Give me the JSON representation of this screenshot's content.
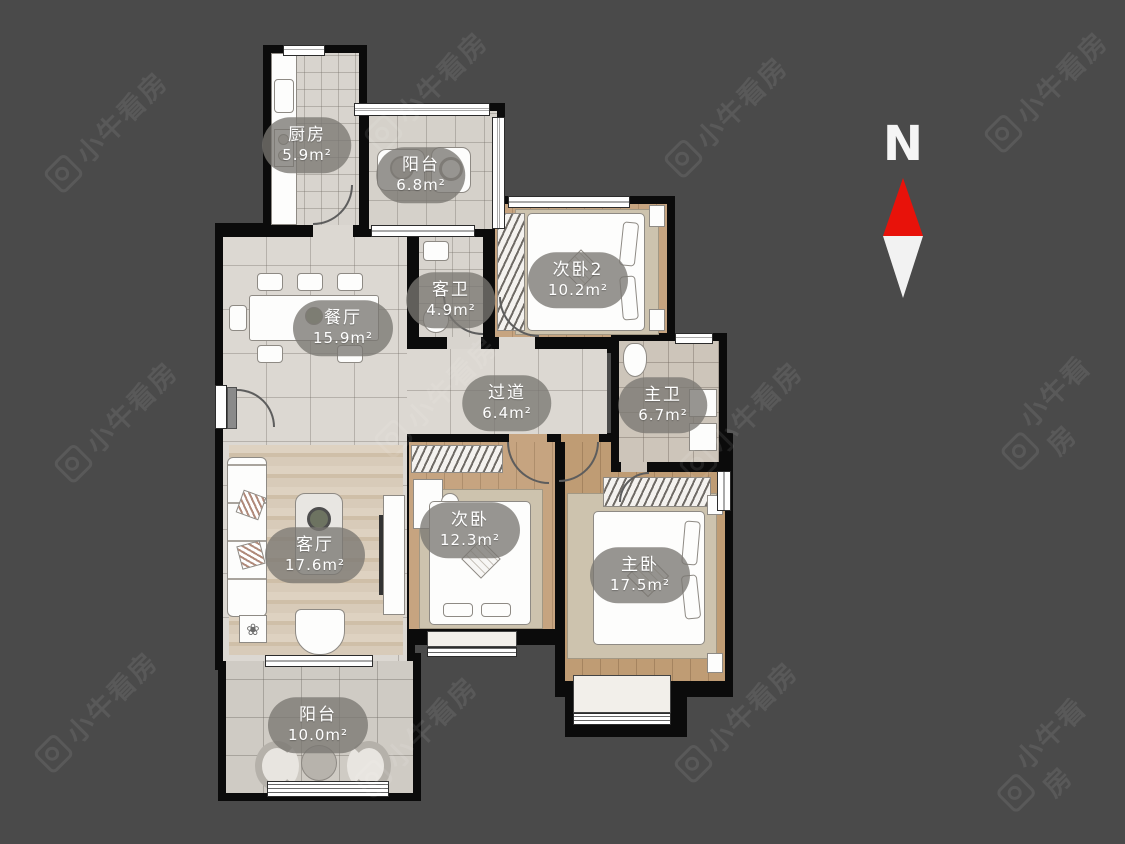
{
  "background": "#4a4a4a",
  "watermark": {
    "text": "小牛看房"
  },
  "compass": {
    "label": "N",
    "arrow_color": "#e8120a"
  },
  "rooms": [
    {
      "name": "厨房",
      "area": "5.9m²"
    },
    {
      "name": "阳台",
      "area": "6.8m²"
    },
    {
      "name": "次卧2",
      "area": "10.2m²"
    },
    {
      "name": "餐厅",
      "area": "15.9m²"
    },
    {
      "name": "客卫",
      "area": "4.9m²"
    },
    {
      "name": "过道",
      "area": "6.4m²"
    },
    {
      "name": "主卫",
      "area": "6.7m²"
    },
    {
      "name": "客厅",
      "area": "17.6m²"
    },
    {
      "name": "次卧",
      "area": "12.3m²"
    },
    {
      "name": "主卧",
      "area": "17.5m²"
    },
    {
      "name": "阳台",
      "area": "10.0m²"
    }
  ]
}
